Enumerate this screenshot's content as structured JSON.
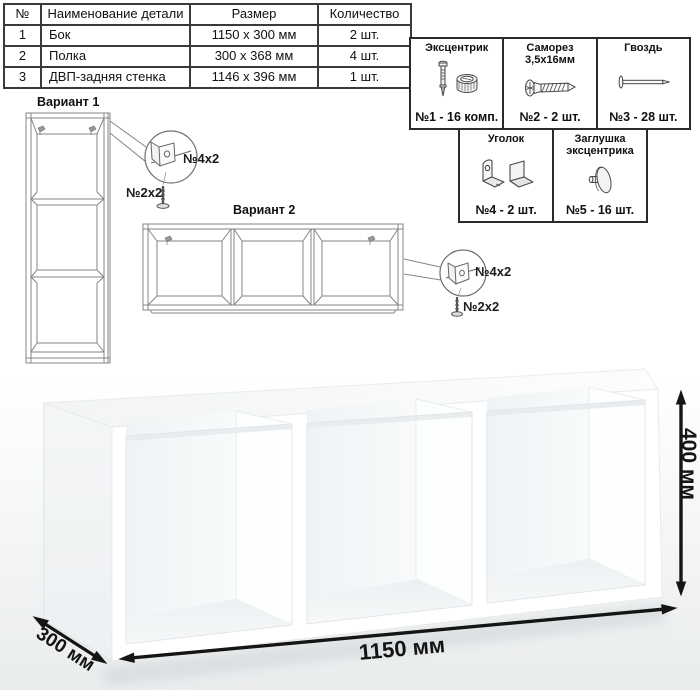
{
  "parts_table": {
    "headers": [
      "№",
      "Наименование детали",
      "Размер",
      "Количество"
    ],
    "rows": [
      [
        "1",
        "Бок",
        "1150 х 300 мм",
        "2 шт."
      ],
      [
        "2",
        "Полка",
        "300 х 368 мм",
        "4 шт."
      ],
      [
        "3",
        "ДВП-задняя стенка",
        "1146 х 396 мм",
        "1 шт."
      ]
    ]
  },
  "hardware": {
    "items": [
      {
        "name": "Эксцентрик",
        "icon": "eccentric-cam-icon",
        "count": "№1 - 16 комп."
      },
      {
        "name": "Саморез 3,5х16мм",
        "icon": "screw-icon",
        "count": "№2 - 2 шт."
      },
      {
        "name": "Гвоздь",
        "icon": "nail-icon",
        "count": "№3 - 28 шт."
      },
      {
        "name": "Уголок",
        "icon": "corner-bracket-icon",
        "count": "№4 - 2 шт."
      },
      {
        "name": "Заглушка эксцентрика",
        "icon": "cam-cap-icon",
        "count": "№5 - 16 шт."
      }
    ]
  },
  "variants": [
    {
      "title": "Вариант 1",
      "bracket_label": "№4х2",
      "screw_label": "№2х2"
    },
    {
      "title": "Вариант 2",
      "bracket_label": "№4х2",
      "screw_label": "№2х2"
    }
  ],
  "dimensions": {
    "width": "1150 мм",
    "height": "400 мм",
    "depth": "300 мм"
  },
  "colors": {
    "line_art": "#858585",
    "dimension_arrows": "#151515",
    "table_border": "#3a3a3a",
    "shelf_shade": "#f1f4f5"
  }
}
